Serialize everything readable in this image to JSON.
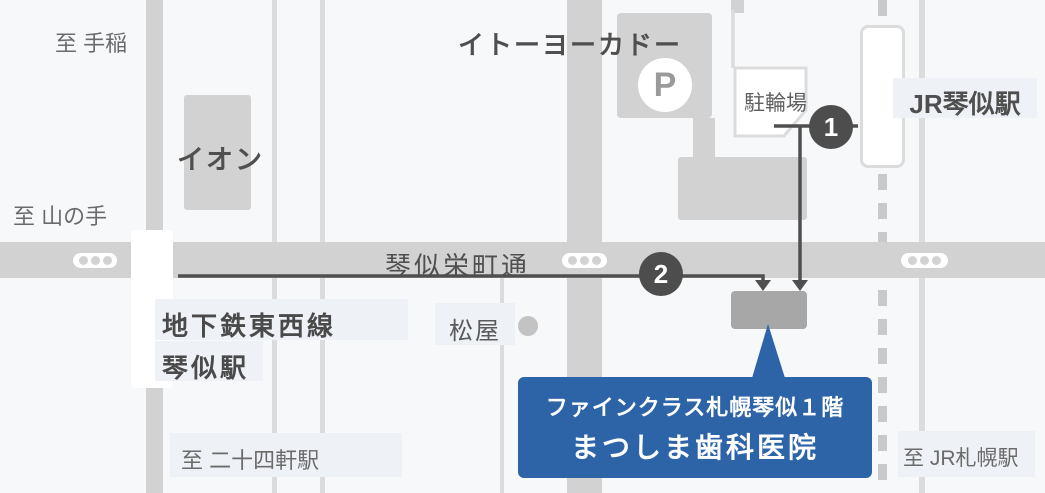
{
  "map_title": "まつしま歯科医院 アクセスマップ",
  "colors": {
    "background": "#f7f8fa",
    "road": "#d2d2d2",
    "thin_road": "#dcdcdc",
    "railway_dash": "#c9c9c9",
    "building": "#d2d2d2",
    "destination_building": "#a7a7a7",
    "route_line": "#4f4f4f",
    "marker": "#4d4d4d",
    "label_background": "#eef1f6",
    "accent_blue": "#2d64a8"
  },
  "edge_labels": {
    "to_teine": "至 手稲",
    "to_yamanote": "至 山の手",
    "to_nijuyonken": "至 二十四軒駅",
    "to_jr_sapporo": "至 JR札幌駅"
  },
  "places": {
    "aeon": "イオン",
    "ito_yokado": "イトーヨーカドー",
    "parking_symbol": "P",
    "bicycle_parking": "駐輪場",
    "jr_station": "JR琴似駅",
    "subway_line": "地下鉄東西線",
    "subway_station": "琴似駅",
    "matsuya": "松屋",
    "street_name": "琴似栄町通"
  },
  "route_markers": {
    "one": "1",
    "two": "2"
  },
  "destination": {
    "line1": "ファインクラス札幌琴似１階",
    "line2": "まつしま歯科医院"
  }
}
